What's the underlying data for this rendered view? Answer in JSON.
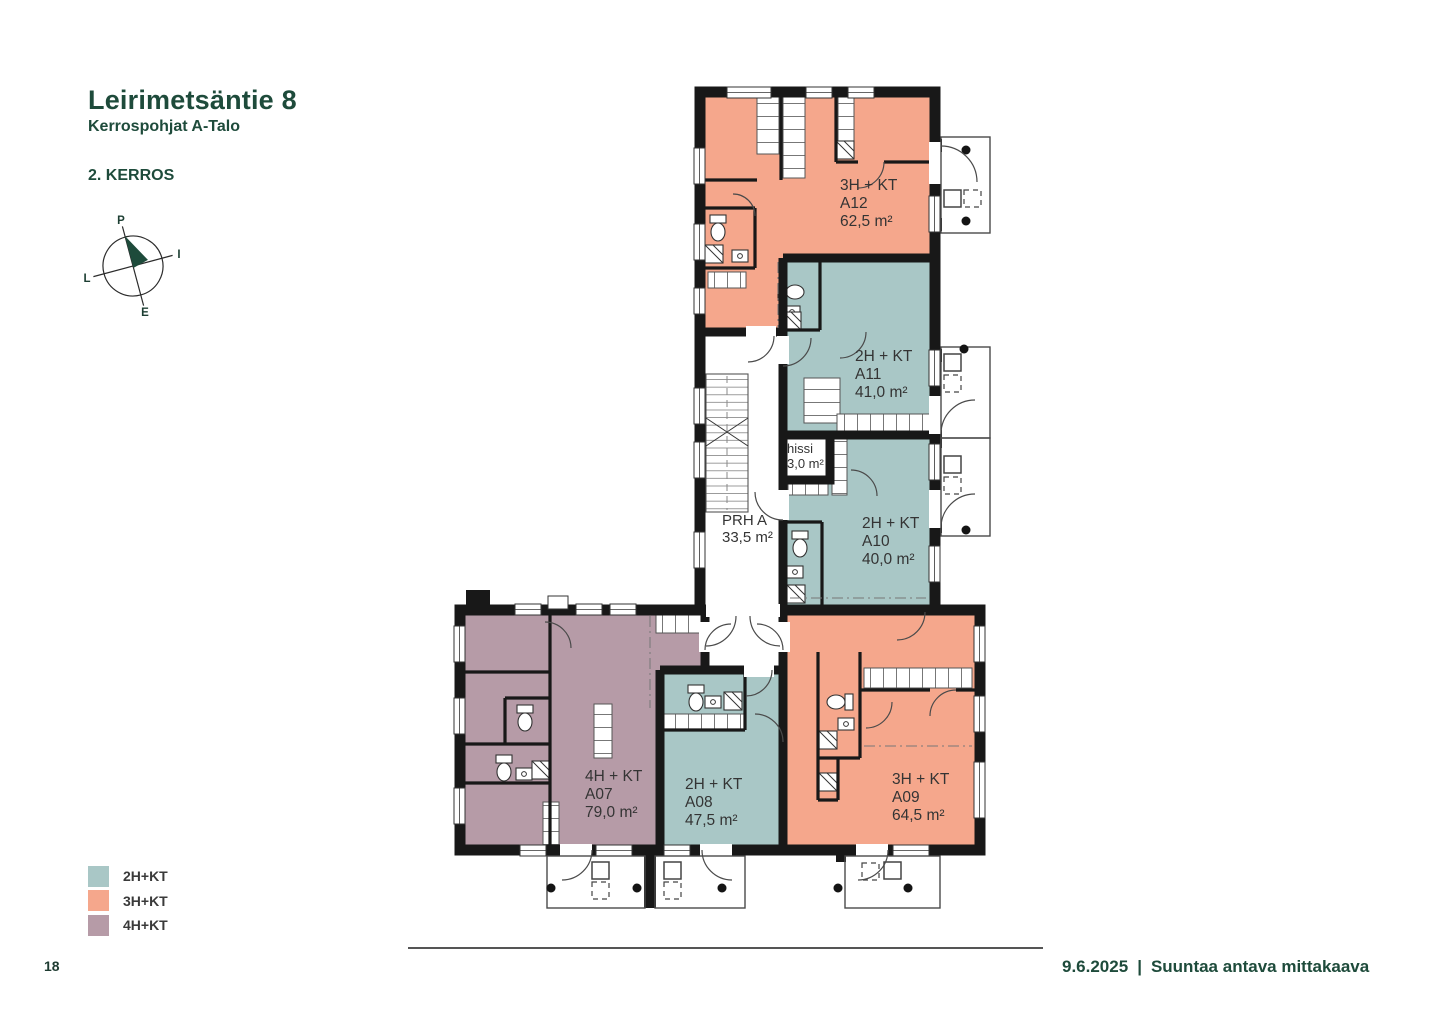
{
  "header": {
    "title": "Leirimetsäntie 8",
    "subtitle": "Kerrospohjat A-Talo",
    "floor_label": "2. KERROS"
  },
  "compass": {
    "north": "P",
    "east": "I",
    "south": "E",
    "west": "L",
    "needle_color": "#1e4b3b"
  },
  "plan": {
    "apartments": [
      {
        "id": "A12",
        "type": "3H + KT",
        "area": "62,5 m²",
        "category": "3H+KT",
        "color": "#f5a78c"
      },
      {
        "id": "A11",
        "type": "2H + KT",
        "area": "41,0 m²",
        "category": "2H+KT",
        "color": "#a9c7c6"
      },
      {
        "id": "A10",
        "type": "2H + KT",
        "area": "40,0 m²",
        "category": "2H+KT",
        "color": "#a9c7c6"
      },
      {
        "id": "A07",
        "type": "4H + KT",
        "area": "79,0 m²",
        "category": "4H+KT",
        "color": "#b69ba7"
      },
      {
        "id": "A08",
        "type": "2H + KT",
        "area": "47,5 m²",
        "category": "2H+KT",
        "color": "#a9c7c6"
      },
      {
        "id": "A09",
        "type": "3H + KT",
        "area": "64,5 m²",
        "category": "3H+KT",
        "color": "#f5a78c"
      }
    ],
    "common_spaces": [
      {
        "name": "hissi",
        "area": "3,0 m²"
      },
      {
        "name": "PRH A",
        "area": "33,5 m²"
      }
    ]
  },
  "legend": {
    "items": [
      {
        "label": "2H+KT",
        "color": "#a9c7c6"
      },
      {
        "label": "3H+KT",
        "color": "#f5a78c"
      },
      {
        "label": "4H+KT",
        "color": "#b69ba7"
      }
    ]
  },
  "footer": {
    "page_number": "18",
    "date": "9.6.2025",
    "separator": "|",
    "note": "Suuntaa antava mittakaava"
  }
}
